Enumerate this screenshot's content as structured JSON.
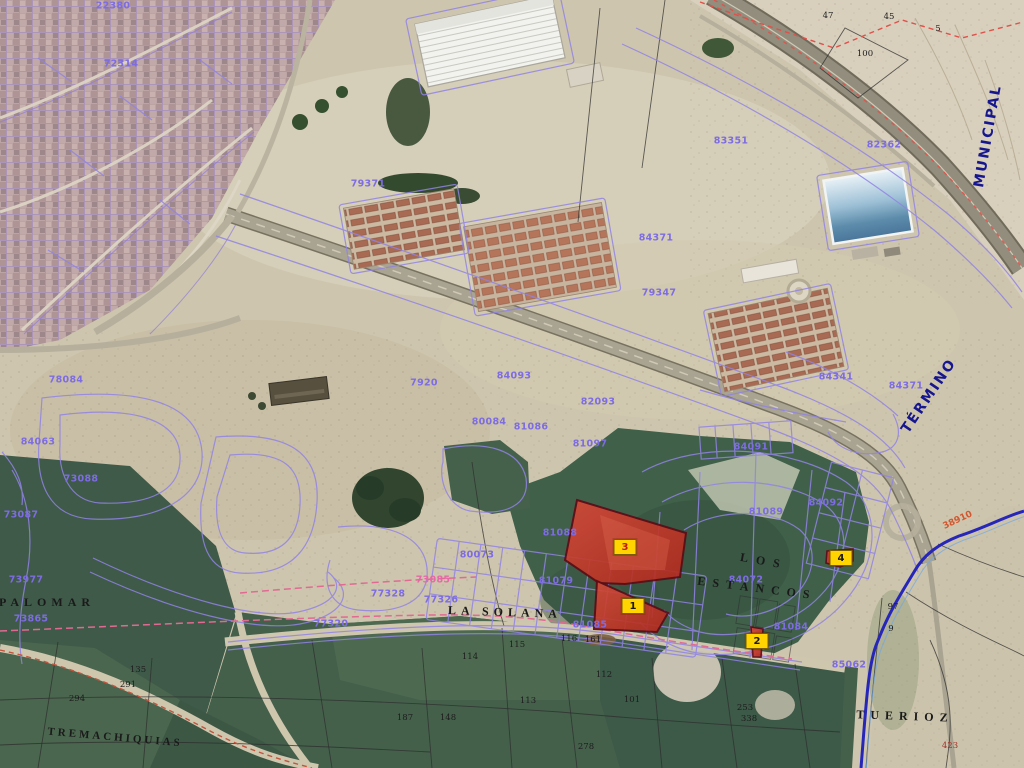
{
  "colors": {
    "cadastral_purple": "#7d6ce2",
    "pink_label": "#e668a8",
    "road_label_red": "#d2572e",
    "boundary_label_blue": "#16168e",
    "boundary_line_blue": "#2626b8",
    "highlight_parcel_red": "#c03022",
    "marker_yellow": "#ffd400",
    "pink_dashed_line": "#e06a92",
    "red_dashed_line": "#e0514a"
  },
  "map": {
    "boundary_labels": [
      {
        "text": "MUNICIPAL",
        "x": 988,
        "y": 136,
        "rot": -80,
        "ls": 2
      },
      {
        "text": "TÉRMINO",
        "x": 929,
        "y": 396,
        "rot": -56,
        "ls": 2
      }
    ],
    "toponyms": [
      {
        "text": "PALOMAR",
        "x": 47,
        "y": 602,
        "rot": 0,
        "ls": 5
      },
      {
        "text": "LA SOLANA",
        "x": 505,
        "y": 612,
        "rot": 2,
        "ls": 5
      },
      {
        "text": "LOS",
        "x": 764,
        "y": 561,
        "rot": 10,
        "ls": 8
      },
      {
        "text": "ESTANCOS",
        "x": 757,
        "y": 588,
        "rot": 7,
        "ls": 7
      },
      {
        "text": "TREMACHIQUIAS",
        "x": 115,
        "y": 738,
        "rot": 5,
        "ls": 3,
        "fs": 11
      },
      {
        "text": "TUERIOZ",
        "x": 905,
        "y": 716,
        "rot": 2,
        "ls": 6
      }
    ],
    "cadastral_labels": [
      {
        "text": "22380",
        "x": 113,
        "y": 6
      },
      {
        "text": "72314",
        "x": 121,
        "y": 64
      },
      {
        "text": "83351",
        "x": 731,
        "y": 141
      },
      {
        "text": "82362",
        "x": 884,
        "y": 145
      },
      {
        "text": "79371",
        "x": 368,
        "y": 184
      },
      {
        "text": "84371",
        "x": 656,
        "y": 238
      },
      {
        "text": "79347",
        "x": 659,
        "y": 293
      },
      {
        "text": "84341",
        "x": 836,
        "y": 377
      },
      {
        "text": "84371",
        "x": 906,
        "y": 386
      },
      {
        "text": "7920",
        "x": 424,
        "y": 383
      },
      {
        "text": "84093",
        "x": 514,
        "y": 376
      },
      {
        "text": "82093",
        "x": 598,
        "y": 402
      },
      {
        "text": "80084",
        "x": 489,
        "y": 422
      },
      {
        "text": "81086",
        "x": 531,
        "y": 427
      },
      {
        "text": "81097",
        "x": 590,
        "y": 444
      },
      {
        "text": "84091",
        "x": 751,
        "y": 447
      },
      {
        "text": "84092",
        "x": 826,
        "y": 503
      },
      {
        "text": "81089",
        "x": 766,
        "y": 512
      },
      {
        "text": "81088",
        "x": 560,
        "y": 533
      },
      {
        "text": "81079",
        "x": 556,
        "y": 581
      },
      {
        "text": "81085",
        "x": 590,
        "y": 625
      },
      {
        "text": "80073",
        "x": 477,
        "y": 555
      },
      {
        "text": "77328",
        "x": 388,
        "y": 594
      },
      {
        "text": "77326",
        "x": 441,
        "y": 600
      },
      {
        "text": "77320",
        "x": 331,
        "y": 624
      },
      {
        "text": "84072",
        "x": 746,
        "y": 580
      },
      {
        "text": "81084",
        "x": 791,
        "y": 627
      },
      {
        "text": "85062",
        "x": 849,
        "y": 665
      },
      {
        "text": "78084",
        "x": 66,
        "y": 380
      },
      {
        "text": "84063",
        "x": 38,
        "y": 442
      },
      {
        "text": "73088",
        "x": 81,
        "y": 479
      },
      {
        "text": "73087",
        "x": 21,
        "y": 515
      },
      {
        "text": "73977",
        "x": 26,
        "y": 580
      },
      {
        "text": "73865",
        "x": 31,
        "y": 619
      }
    ],
    "pink_labels": [
      {
        "text": "73085",
        "x": 433,
        "y": 580
      }
    ],
    "road_labels": [
      {
        "text": "38910",
        "x": 958,
        "y": 521,
        "rot": -25
      }
    ],
    "field_numbers": [
      {
        "text": "47",
        "x": 828,
        "y": 16
      },
      {
        "text": "45",
        "x": 889,
        "y": 17
      },
      {
        "text": "5",
        "x": 938,
        "y": 29
      },
      {
        "text": "100",
        "x": 865,
        "y": 54
      },
      {
        "text": "97",
        "x": 893,
        "y": 607
      },
      {
        "text": "9",
        "x": 891,
        "y": 629
      },
      {
        "text": "291",
        "x": 128,
        "y": 685
      },
      {
        "text": "294",
        "x": 77,
        "y": 699
      },
      {
        "text": "135",
        "x": 138,
        "y": 670
      },
      {
        "text": "114",
        "x": 470,
        "y": 657
      },
      {
        "text": "115",
        "x": 517,
        "y": 645
      },
      {
        "text": "116",
        "x": 569,
        "y": 639
      },
      {
        "text": "161",
        "x": 593,
        "y": 640
      },
      {
        "text": "112",
        "x": 604,
        "y": 675
      },
      {
        "text": "113",
        "x": 528,
        "y": 701
      },
      {
        "text": "101",
        "x": 632,
        "y": 700
      },
      {
        "text": "187",
        "x": 405,
        "y": 718
      },
      {
        "text": "148",
        "x": 448,
        "y": 718
      },
      {
        "text": "278",
        "x": 586,
        "y": 747
      },
      {
        "text": "253",
        "x": 745,
        "y": 708
      },
      {
        "text": "338",
        "x": 749,
        "y": 719
      },
      {
        "text": "423",
        "x": 950,
        "y": 746,
        "color": "#a03026"
      }
    ],
    "highlight_parcels": [
      {
        "num": "3",
        "x": 625,
        "y": 547,
        "color": "#c01818"
      },
      {
        "num": "1",
        "x": 633,
        "y": 606
      },
      {
        "num": "4",
        "x": 841,
        "y": 558
      },
      {
        "num": "2",
        "x": 757,
        "y": 641
      }
    ]
  }
}
